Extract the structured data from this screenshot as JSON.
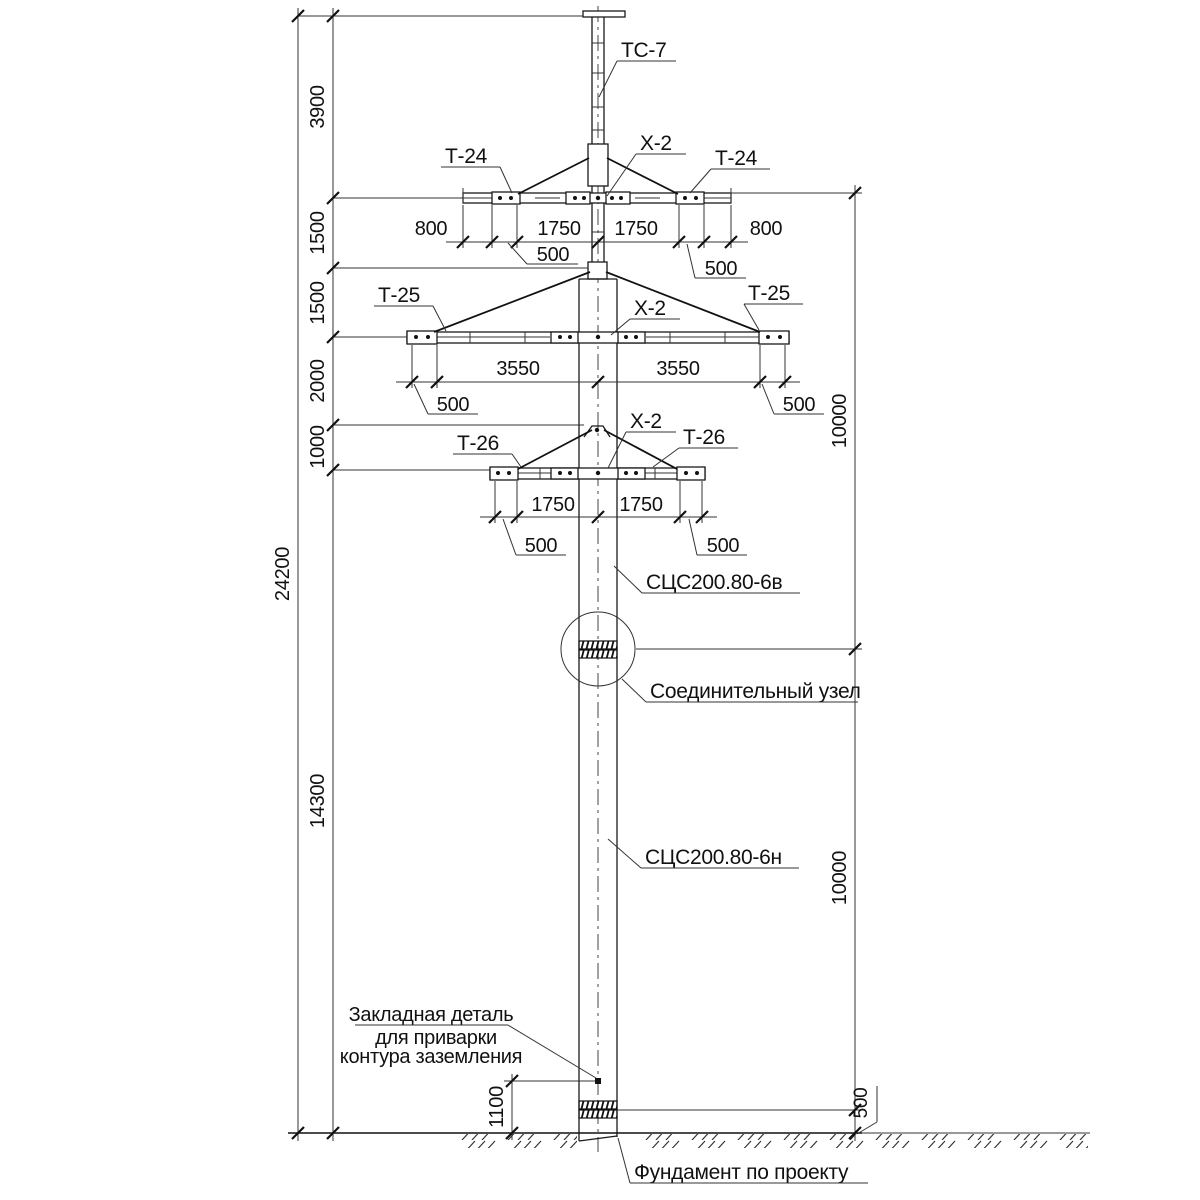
{
  "drawing": {
    "labels": {
      "top_section": "ТС-7",
      "connector_level1": "Х-2",
      "connector_level2": "Х-2",
      "connector_level3": "Х-2",
      "traverse1_left": "Т-24",
      "traverse1_right": "Т-24",
      "traverse2_left": "Т-25",
      "traverse2_right": "Т-25",
      "traverse3_left": "Т-26",
      "traverse3_right": "Т-26",
      "pole_upper_section": "СЦС200.80-6в",
      "pole_lower_section": "СЦС200.80-6н",
      "joint": "Соединительный узел",
      "embedded_plate": [
        "Закладная деталь",
        "для приварки",
        "контура заземления"
      ],
      "foundation": "Фундамент по проекту"
    },
    "dimensions": {
      "overall_height": "24200",
      "left": {
        "top_to_level1": "3900",
        "level1_to_anchor": "1500",
        "anchor_to_level2": "1500",
        "level2_to_anchor": "2000",
        "anchor_to_level3": "1000",
        "level3_to_ground": "14300"
      },
      "right": {
        "upper_section": "10000",
        "lower_section": "10000",
        "embedment": "500"
      },
      "ground_clearance": "1100",
      "level1": {
        "outer_left": "800",
        "inner_left": "1750",
        "inner_right": "1750",
        "outer_right": "800",
        "offset_left": "500",
        "offset_right": "500"
      },
      "level2": {
        "inner_left": "3550",
        "inner_right": "3550",
        "offset_left": "500",
        "offset_right": "500"
      },
      "level3": {
        "inner_left": "1750",
        "inner_right": "1750",
        "offset_left": "500",
        "offset_right": "500"
      }
    },
    "colors": {
      "line": "#1a1a1a",
      "background": "#ffffff"
    }
  }
}
